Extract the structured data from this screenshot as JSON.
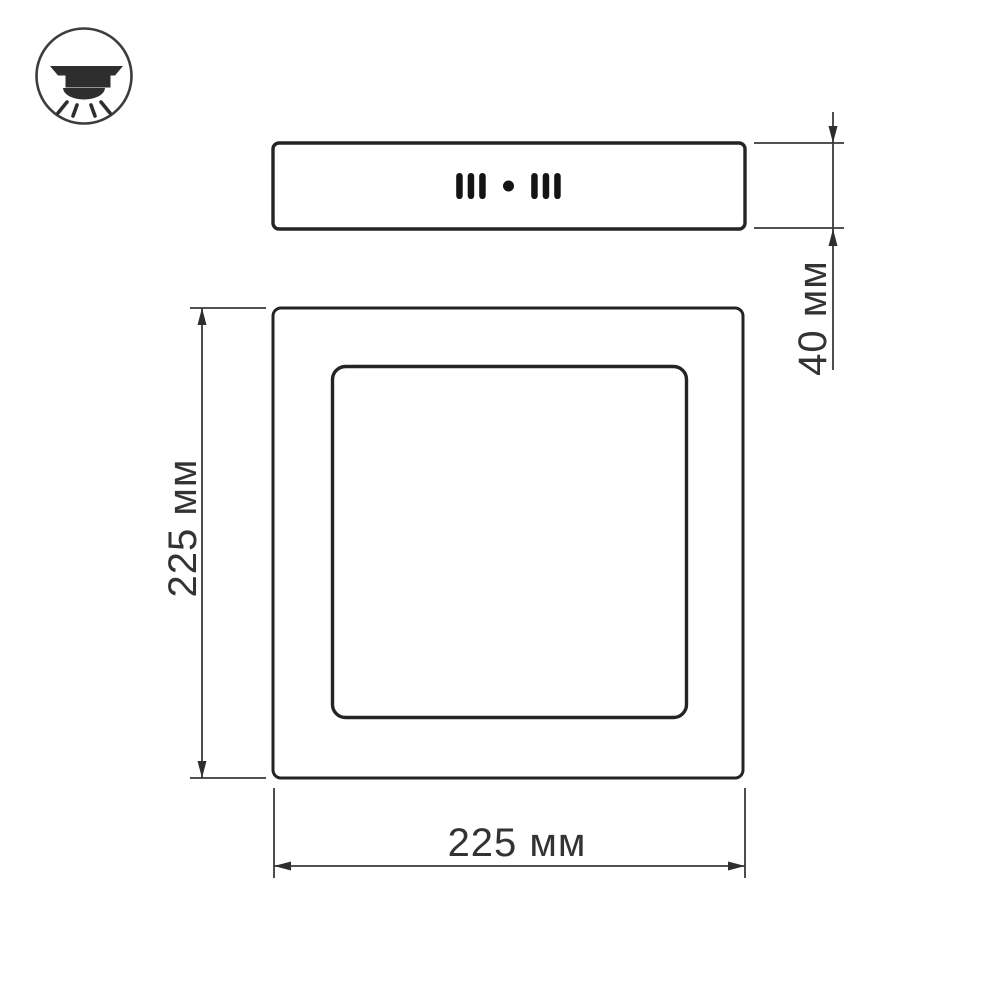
{
  "drawing": {
    "type": "product-dimension-diagram",
    "subject": "surface-mounted square LED panel",
    "background_color": "#ffffff",
    "outline_color": "#242424",
    "dimension_color": "#3a3a3a",
    "text_color": "#333333",
    "icon": {
      "name": "surface-mounted-downlight",
      "description": "circled ceiling downlight glyph with 4 light rays"
    },
    "views": {
      "side_view": {
        "name": "panel side profile",
        "slot_groups": 2,
        "slots_per_group": 3,
        "has_center_dot": true
      },
      "front_view": {
        "name": "panel front face",
        "outer_square": true,
        "inner_square": true
      }
    },
    "dimensions": {
      "height": {
        "label": "40 мм",
        "value": 40,
        "unit": "мм"
      },
      "side": {
        "label": "225 мм",
        "value": 225,
        "unit": "мм"
      },
      "width": {
        "label": "225 мм",
        "value": 225,
        "unit": "мм"
      }
    }
  }
}
